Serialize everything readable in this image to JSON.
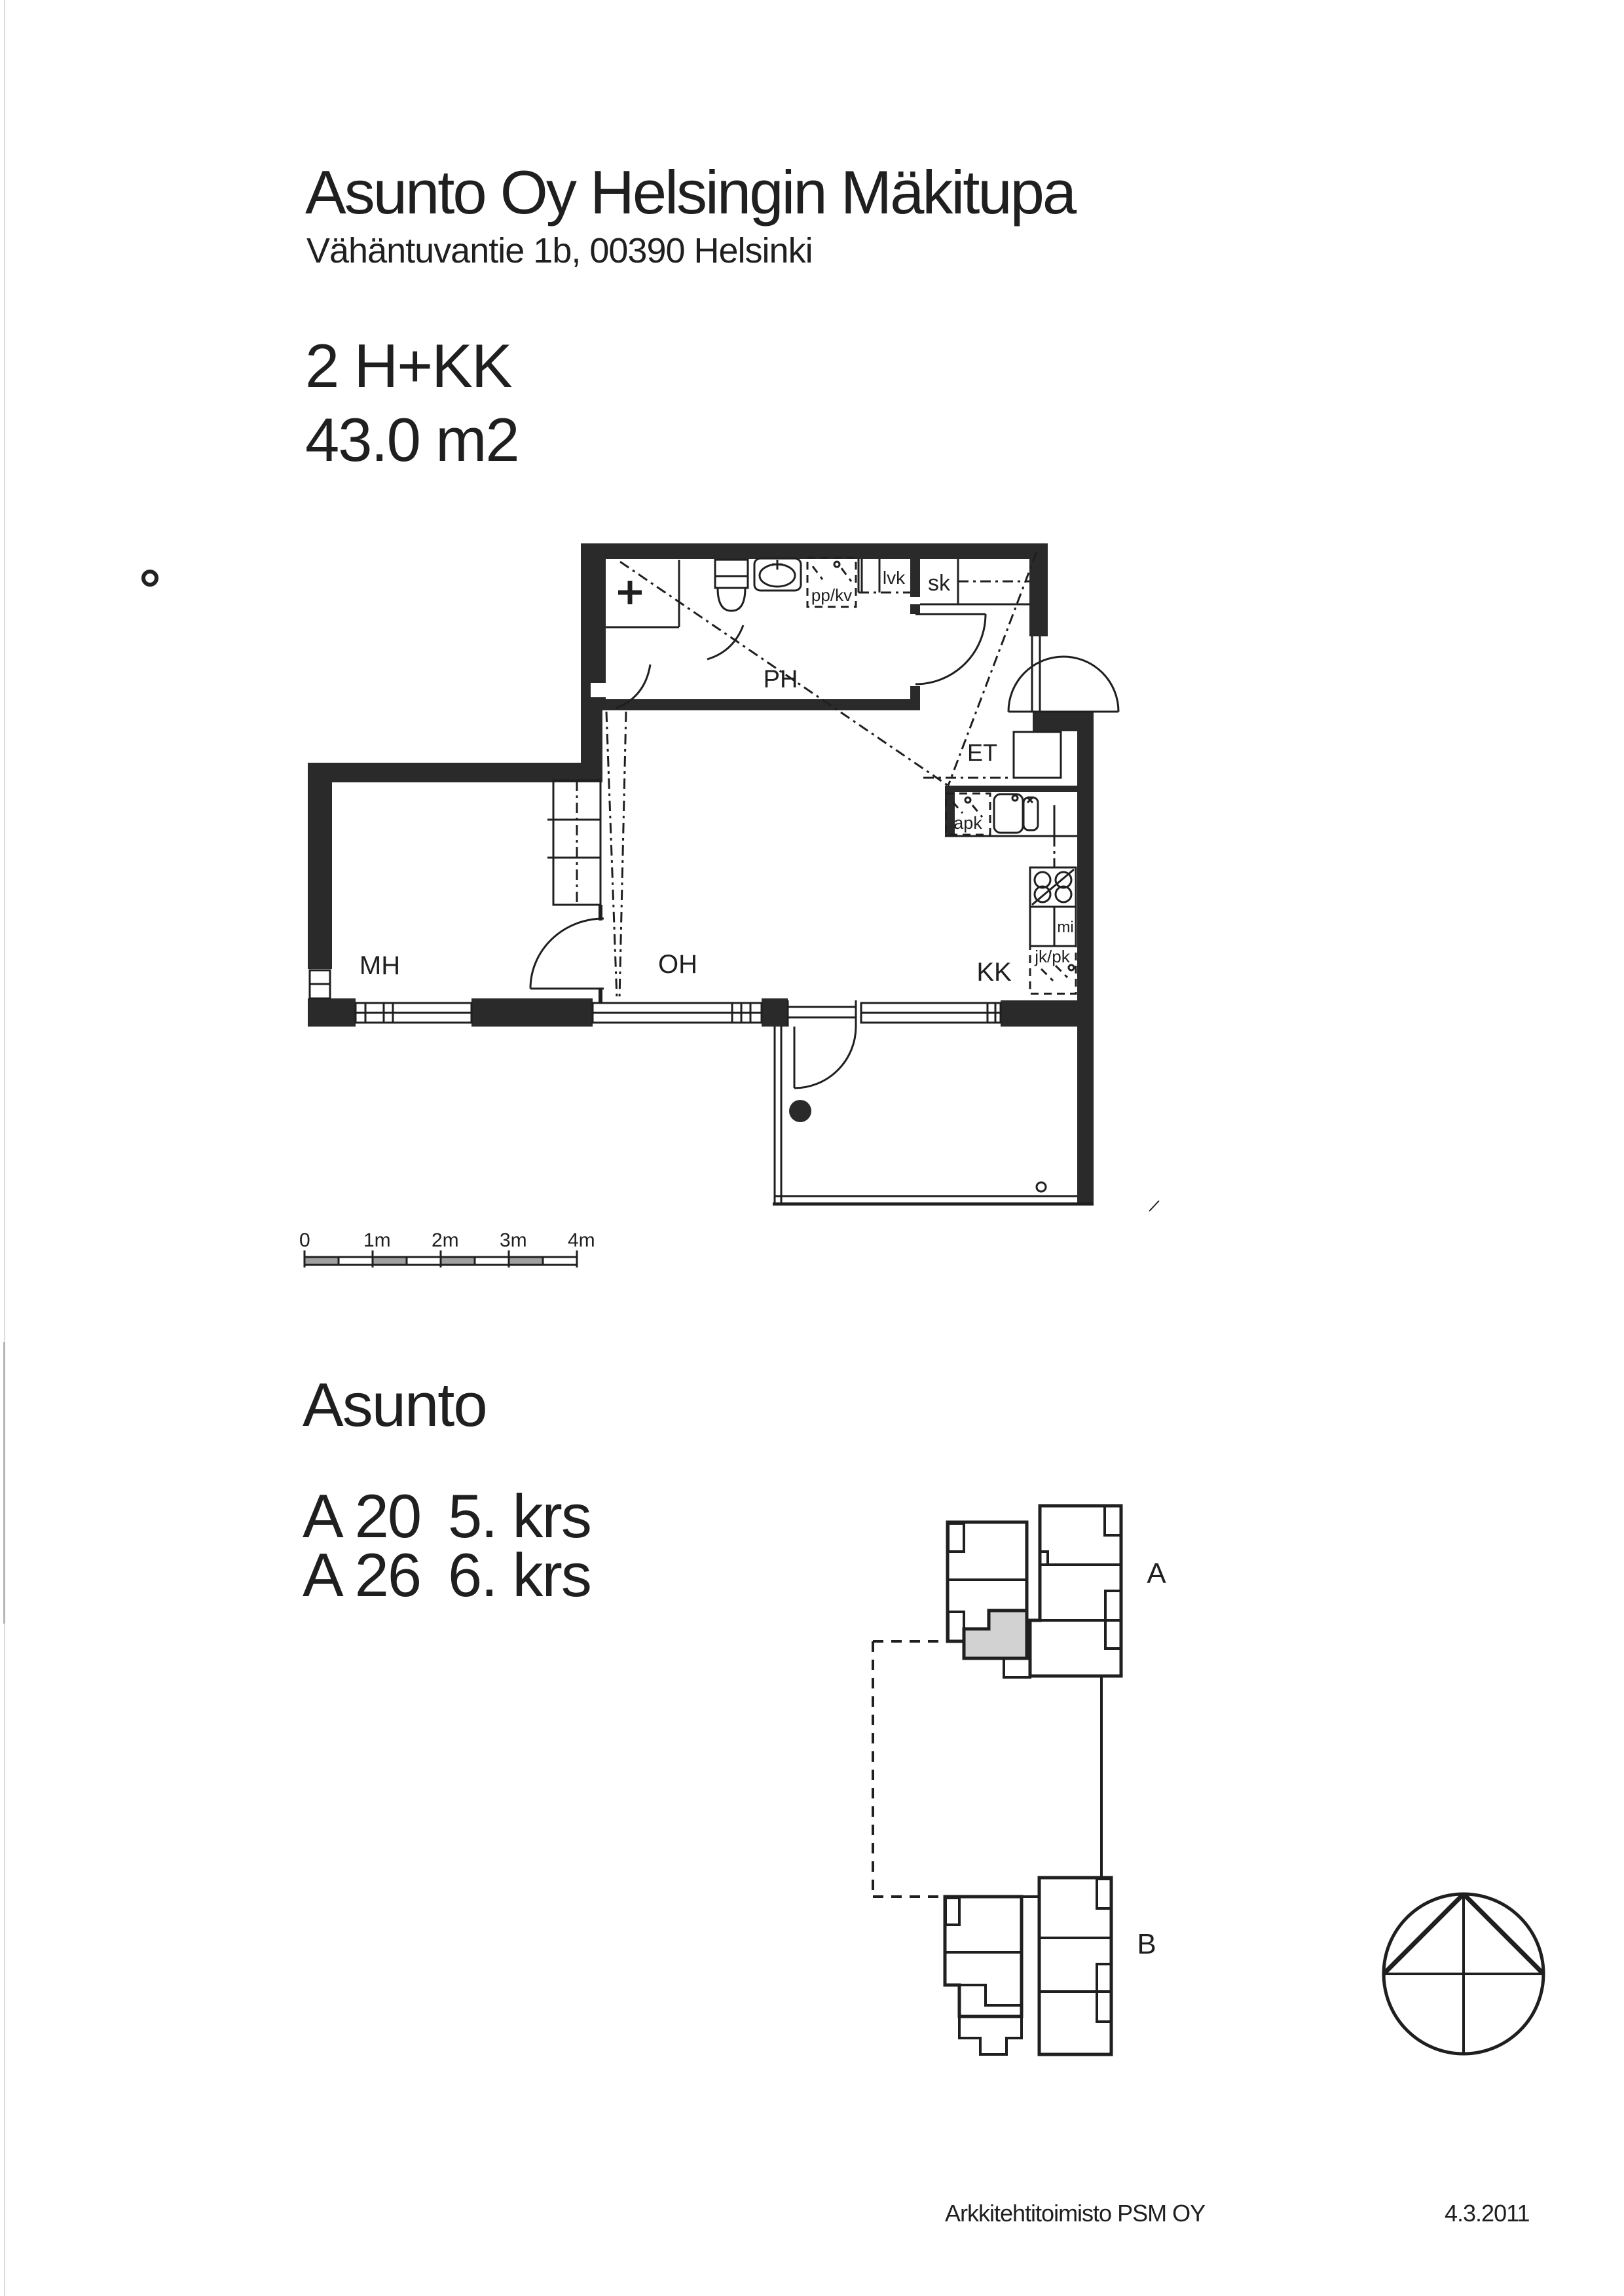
{
  "header": {
    "title": "Asunto Oy Helsingin Mäkitupa",
    "address": "Vähäntuvantie 1b, 00390 Helsinki",
    "apartment_type": "2 H+KK",
    "apartment_area": "43.0 m2"
  },
  "floor_plan": {
    "rooms": {
      "mh": "MH",
      "oh": "OH",
      "kk": "KK",
      "ph": "PH",
      "et": "ET"
    },
    "fixtures": {
      "sk": "sk",
      "lvk": "lvk",
      "ppkv": "pp/kv",
      "apk": "apk",
      "mi": "mi",
      "jkpk": "jk/pk"
    }
  },
  "scale_bar": {
    "labels": [
      "0",
      "1m",
      "2m",
      "3m",
      "4m"
    ]
  },
  "apartment_list": {
    "heading": "Asunto",
    "units": [
      {
        "id": "A 20",
        "floor": "5. krs"
      },
      {
        "id": "A 26",
        "floor": "6. krs"
      }
    ]
  },
  "site_plan": {
    "stairwell_a": "A",
    "stairwell_b": "B"
  },
  "footer": {
    "architect": "Arkkitehtitoimisto PSM OY",
    "date": "4.3.2011"
  },
  "colors": {
    "ink": "#1f1f1f",
    "wall": "#2a2a2a",
    "highlight_unit": "#d2d2d2",
    "scale_gray": "#a0a0a0"
  }
}
